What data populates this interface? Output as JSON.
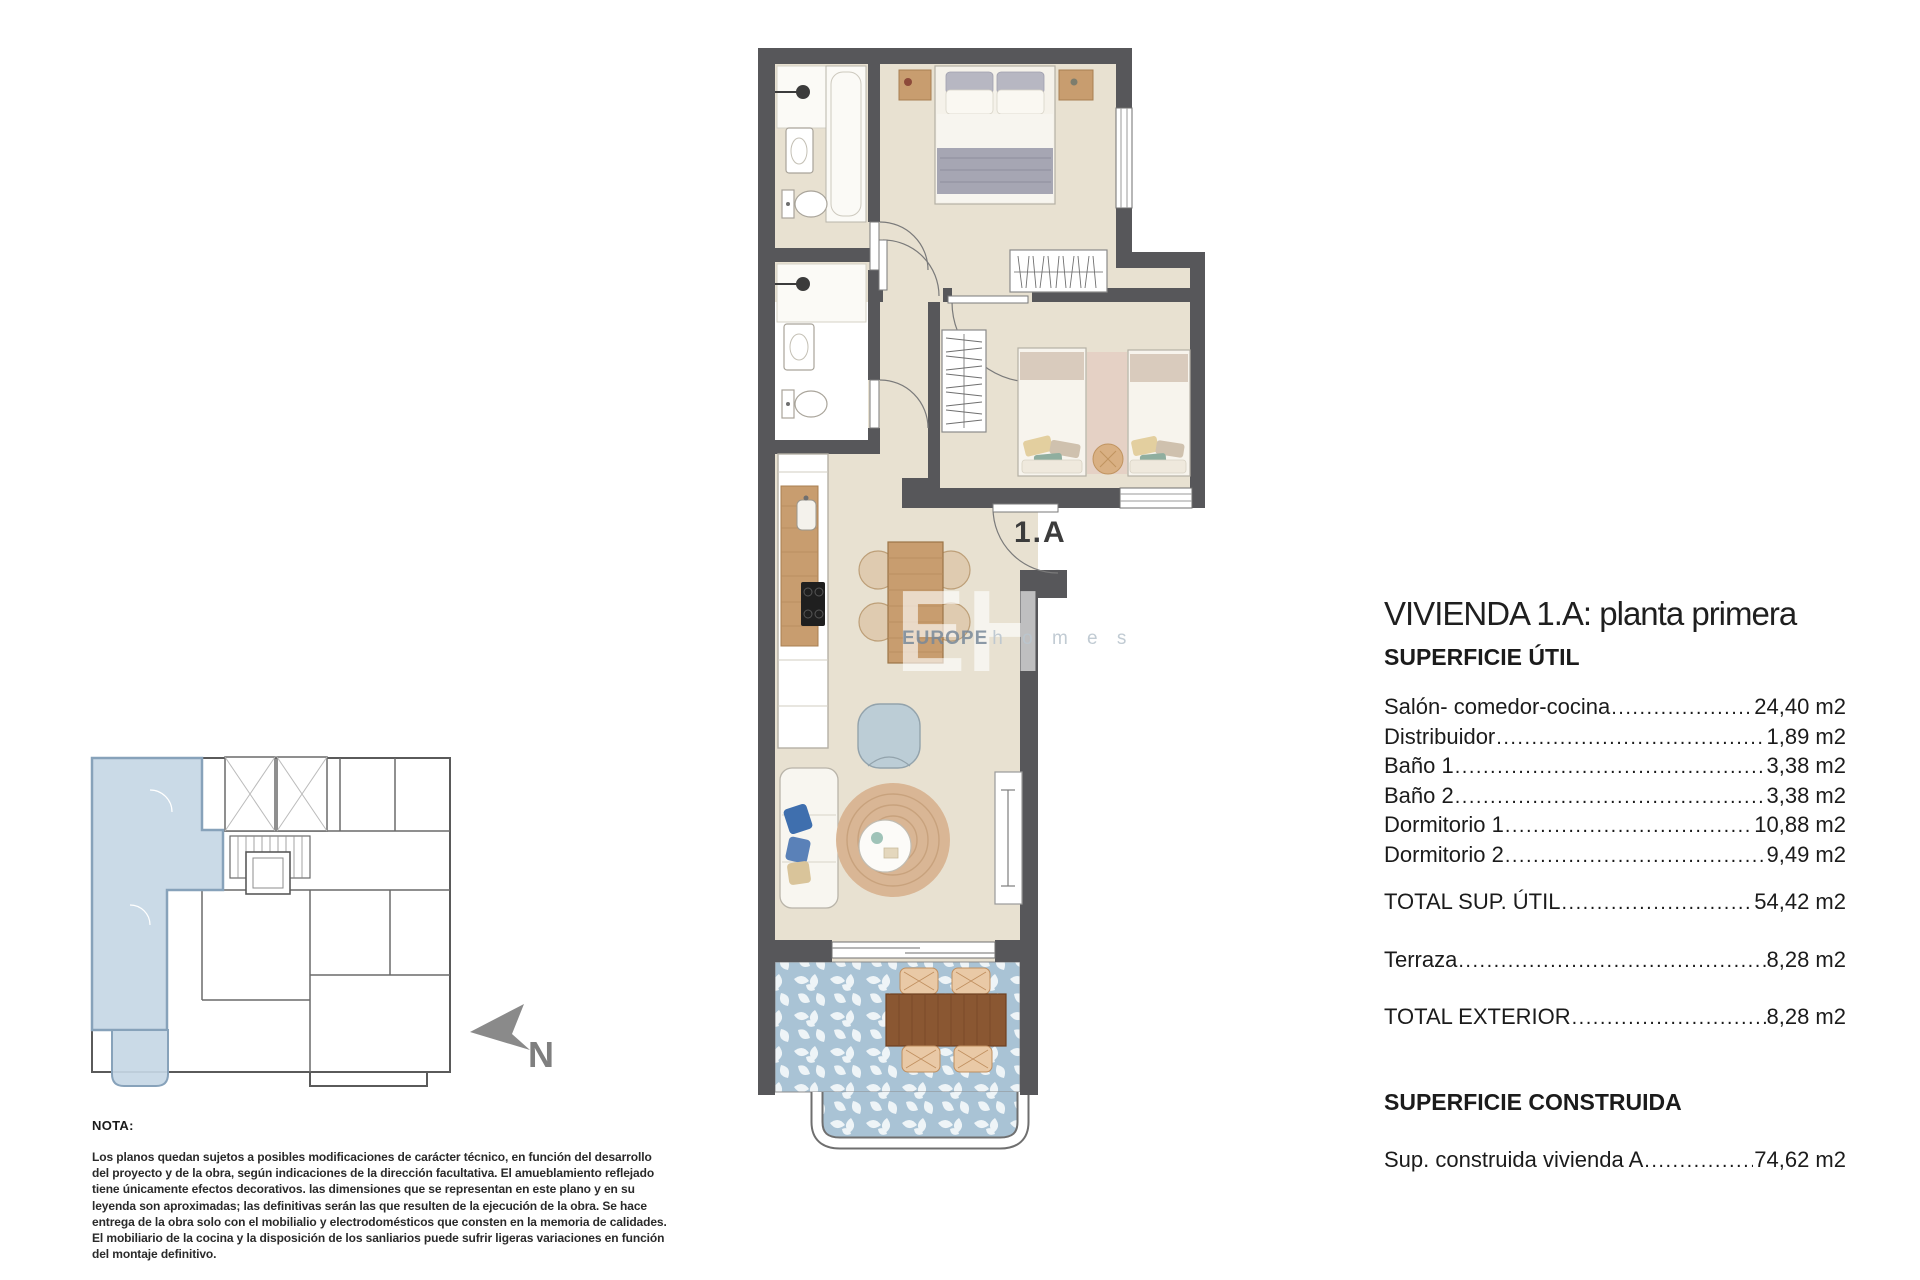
{
  "colors": {
    "wall": "#57575a",
    "floor": "#e8e1d1",
    "terrace_tile": "#a9c3d5",
    "unit_highlight": "#c5d7e5",
    "wood": "#c89d6f",
    "text": "#1b1b1b"
  },
  "plan": {
    "unit_label": "1.A"
  },
  "key_plan": {
    "north_label": "N"
  },
  "watermark": {
    "initials": "EH",
    "brand_bold": "EUROPE",
    "brand_light": "h o m e s"
  },
  "panel": {
    "title": "VIVIENDA 1.A: planta primera",
    "util_header": "SUPERFICIE ÚTIL",
    "util_rows": [
      {
        "label": "Salón- comedor-cocina",
        "value": "24,40 m2"
      },
      {
        "label": "Distribuidor",
        "value": "1,89 m2"
      },
      {
        "label": "Baño 1",
        "value": "3,38 m2"
      },
      {
        "label": "Baño 2",
        "value": "3,38 m2"
      },
      {
        "label": "Dormitorio 1",
        "value": "10,88 m2"
      },
      {
        "label": "Dormitorio 2",
        "value": "9,49 m2"
      }
    ],
    "total_util": {
      "label": "TOTAL SUP. ÚTIL",
      "value": "54,42 m2"
    },
    "terraza": {
      "label": "Terraza",
      "value": "8,28 m2"
    },
    "total_exterior": {
      "label": "TOTAL EXTERIOR",
      "value": "8,28 m2"
    },
    "construida_header": "SUPERFICIE CONSTRUIDA",
    "construida_row": {
      "label": "Sup. construida vivienda A",
      "value": "74,62 m2"
    }
  },
  "nota": {
    "heading": "NOTA:",
    "lines": [
      "Los planos quedan sujetos a posibles modificaciones de carácter técnico, en función del desarrollo",
      "del proyecto y de la obra, según indicaciones de la dirección facultativa. El amueblamiento reflejado",
      "tiene únicamente efectos decorativos. las dimensiones que se representan en este plano y en su",
      "leyenda son aproximadas; las definitivas serán las que resulten de la ejecución de la obra. Se hace",
      "entrega de la obra solo con el mobilialio y electrodomésticos que consten en la memoria de calidades.",
      "El mobiliario de la cocina y la disposición de los sanliarios puede sufrir ligeras variaciones en función",
      "del montaje definitivo."
    ]
  }
}
